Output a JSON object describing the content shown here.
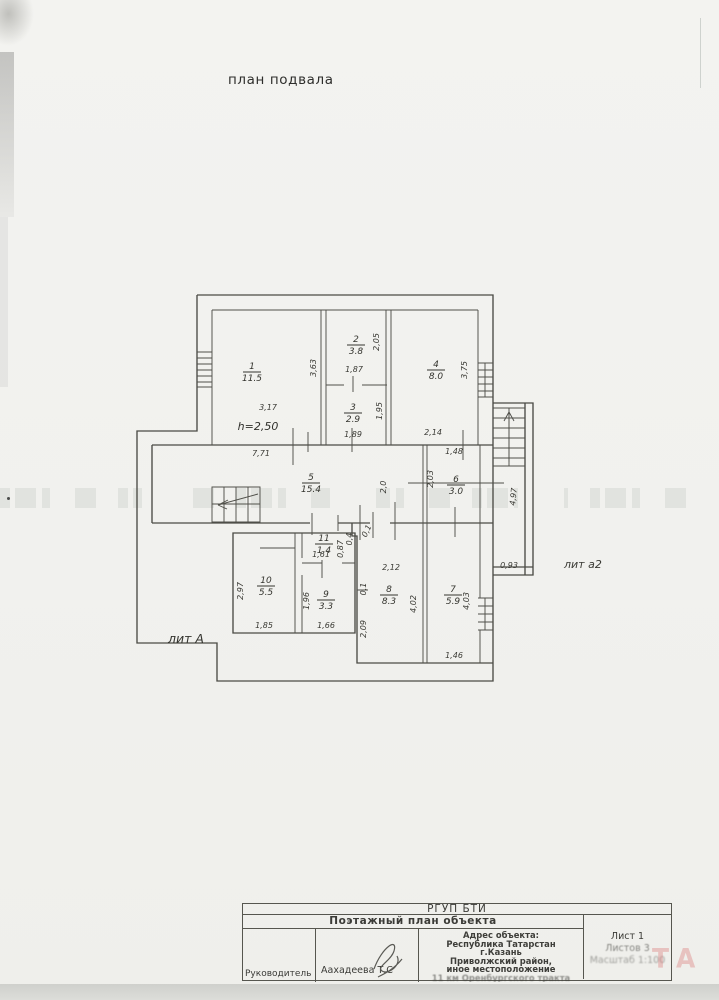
{
  "page": {
    "title": "план подвала"
  },
  "plan": {
    "height_note": "h=2,50",
    "building_label": "лит А",
    "annex_label": "лит а2",
    "rooms": [
      {
        "num": "1",
        "area": "11.5",
        "x": 252,
        "y": 371
      },
      {
        "num": "2",
        "area": "3.8",
        "x": 356,
        "y": 344
      },
      {
        "num": "3",
        "area": "2.9",
        "x": 353,
        "y": 412
      },
      {
        "num": "4",
        "area": "8.0",
        "x": 436,
        "y": 369
      },
      {
        "num": "5",
        "area": "15.4",
        "x": 311,
        "y": 482
      },
      {
        "num": "6",
        "area": "3.0",
        "x": 456,
        "y": 484
      },
      {
        "num": "7",
        "area": "5.9",
        "x": 453,
        "y": 594
      },
      {
        "num": "8",
        "area": "8.3",
        "x": 389,
        "y": 594
      },
      {
        "num": "9",
        "area": "3.3",
        "x": 326,
        "y": 599
      },
      {
        "num": "10",
        "area": "5.5",
        "x": 266,
        "y": 585
      },
      {
        "num": "11",
        "area": "1.4",
        "x": 324,
        "y": 543
      }
    ],
    "dims": [
      {
        "t": "3,63",
        "x": 316,
        "y": 368,
        "r": -90
      },
      {
        "t": "2,05",
        "x": 379,
        "y": 342,
        "r": -90
      },
      {
        "t": "1,87",
        "x": 354,
        "y": 372,
        "r": 0
      },
      {
        "t": "3,17",
        "x": 268,
        "y": 410,
        "r": 0
      },
      {
        "t": "1,95",
        "x": 382,
        "y": 411,
        "r": -90
      },
      {
        "t": "1,89",
        "x": 353,
        "y": 437,
        "r": 0
      },
      {
        "t": "2,14",
        "x": 433,
        "y": 435,
        "r": 0
      },
      {
        "t": "3,75",
        "x": 467,
        "y": 370,
        "r": -90
      },
      {
        "t": "7,71",
        "x": 261,
        "y": 456,
        "r": 0
      },
      {
        "t": "1,48",
        "x": 454,
        "y": 454,
        "r": 0
      },
      {
        "t": "2,0",
        "x": 386,
        "y": 487,
        "r": -90
      },
      {
        "t": "2,03",
        "x": 433,
        "y": 479,
        "r": -90
      },
      {
        "t": "4,97",
        "x": 516,
        "y": 497,
        "r": -84
      },
      {
        "t": "0,93",
        "x": 509,
        "y": 568,
        "r": 0
      },
      {
        "t": "0,87",
        "x": 343,
        "y": 549,
        "r": -90
      },
      {
        "t": "1,61",
        "x": 321,
        "y": 557,
        "r": 0
      },
      {
        "t": "0,4",
        "x": 352,
        "y": 539,
        "r": -90
      },
      {
        "t": "0,1",
        "x": 369,
        "y": 532,
        "r": -65
      },
      {
        "t": "2,97",
        "x": 243,
        "y": 591,
        "r": -90
      },
      {
        "t": "1,85",
        "x": 264,
        "y": 628,
        "r": 0
      },
      {
        "t": "1,96",
        "x": 309,
        "y": 601,
        "r": -90
      },
      {
        "t": "1,66",
        "x": 326,
        "y": 628,
        "r": 0
      },
      {
        "t": "2,12",
        "x": 391,
        "y": 570,
        "r": 0
      },
      {
        "t": "0,1",
        "x": 366,
        "y": 589,
        "r": -90
      },
      {
        "t": "2,09",
        "x": 366,
        "y": 629,
        "r": -90
      },
      {
        "t": "4,02",
        "x": 416,
        "y": 604,
        "r": -90
      },
      {
        "t": "4,03",
        "x": 469,
        "y": 601,
        "r": -90
      },
      {
        "t": "1,46",
        "x": 454,
        "y": 658,
        "r": 0
      }
    ]
  },
  "titleblock": {
    "org": "РГУП БТИ",
    "doc_type": "Поэтажный план объекта",
    "role_label": "Руководитель",
    "signer": "Аахадеева Т.С",
    "address_title": "Адрес объекта:",
    "address_lines": [
      "Республика Татарстан",
      "г.Казань",
      "Приволжский район,",
      "иное местоположение",
      "11 км Оренбургского тракта"
    ],
    "sheet": "Лист 1",
    "sheets_total": "Листов 3",
    "scale": "Масштаб 1:100"
  },
  "artifacts": {
    "pink_mark": "ТА"
  }
}
